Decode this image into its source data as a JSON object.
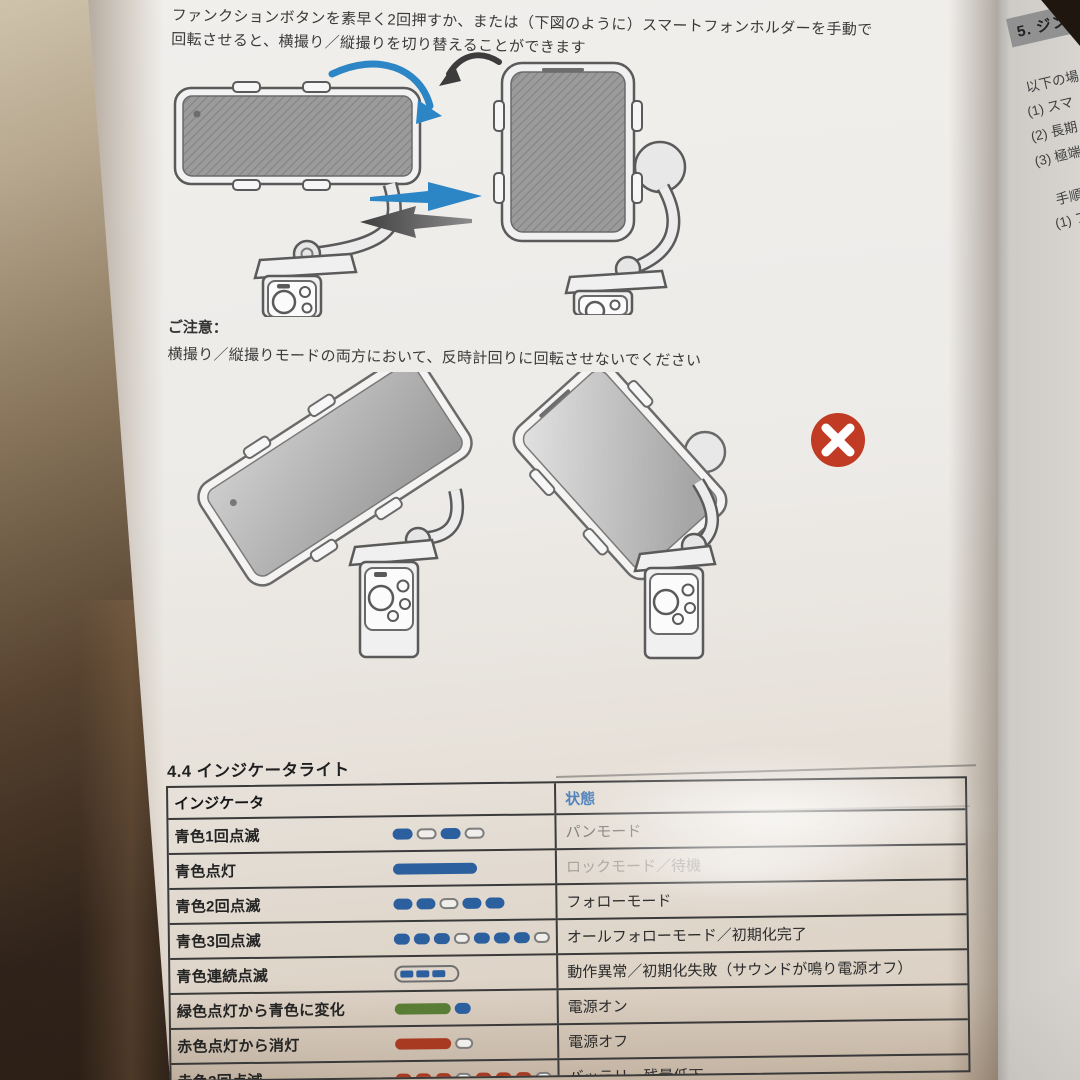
{
  "page": {
    "top_paragraph": {
      "line1": "ファンクションボタンを素早く2回押すか、または（下図のように）スマートフォンホルダーを手動で",
      "line2": "回転させると、横撮り／縦撮りを切り替えることができます"
    },
    "caution": {
      "title": "ご注意：",
      "body": "横撮り／縦撮りモードの両方において、反時計回りに回転させないでください"
    },
    "indicator_section": {
      "title": "4.4 インジケータライト",
      "table": {
        "headers": {
          "indicator": "インジケータ",
          "status": "状態"
        },
        "rows": [
          {
            "label": "青色1回点滅",
            "status": "パンモード",
            "pattern": {
              "kind": "pills",
              "items": [
                {
                  "color": "blue",
                  "w": 20
                },
                {
                  "color": "off",
                  "w": 20
                },
                {
                  "color": "blue",
                  "w": 20
                },
                {
                  "color": "off",
                  "w": 20
                }
              ]
            }
          },
          {
            "label": "青色点灯",
            "status": "ロックモード／待機",
            "pattern": {
              "kind": "pills",
              "items": [
                {
                  "color": "blue",
                  "w": 84
                }
              ]
            }
          },
          {
            "label": "青色2回点滅",
            "status": "フォローモード",
            "pattern": {
              "kind": "pills",
              "items": [
                {
                  "color": "blue",
                  "w": 19
                },
                {
                  "color": "blue",
                  "w": 19
                },
                {
                  "color": "off",
                  "w": 19
                },
                {
                  "color": "blue",
                  "w": 19
                },
                {
                  "color": "blue",
                  "w": 19
                }
              ]
            }
          },
          {
            "label": "青色3回点滅",
            "status": "オールフォローモード／初期化完了",
            "pattern": {
              "kind": "pills",
              "items": [
                {
                  "color": "blue",
                  "w": 16
                },
                {
                  "color": "blue",
                  "w": 16
                },
                {
                  "color": "blue",
                  "w": 16
                },
                {
                  "color": "off",
                  "w": 16
                },
                {
                  "color": "blue",
                  "w": 16
                },
                {
                  "color": "blue",
                  "w": 16
                },
                {
                  "color": "blue",
                  "w": 16
                },
                {
                  "color": "off",
                  "w": 16
                }
              ]
            }
          },
          {
            "label": "青色連続点滅",
            "status": "動作異常／初期化失敗（サウンドが鳴り電源オフ）",
            "pattern": {
              "kind": "capsule",
              "items": [
                {
                  "color": "blue"
                },
                {
                  "color": "blue"
                },
                {
                  "color": "blue"
                }
              ]
            }
          },
          {
            "label": "緑色点灯から青色に変化",
            "status": "電源オン",
            "pattern": {
              "kind": "pills",
              "items": [
                {
                  "color": "green",
                  "w": 56
                },
                {
                  "color": "blue",
                  "w": 16
                }
              ]
            }
          },
          {
            "label": "赤色点灯から消灯",
            "status": "電源オフ",
            "pattern": {
              "kind": "pills",
              "items": [
                {
                  "color": "red",
                  "w": 56
                },
                {
                  "color": "off",
                  "w": 18
                }
              ]
            }
          },
          {
            "label": "赤色3回点滅",
            "status": "バッテリー残量低下",
            "pattern": {
              "kind": "pills",
              "items": [
                {
                  "color": "red",
                  "w": 16
                },
                {
                  "color": "red",
                  "w": 16
                },
                {
                  "color": "red",
                  "w": 16
                },
                {
                  "color": "off",
                  "w": 16
                },
                {
                  "color": "red",
                  "w": 16
                },
                {
                  "color": "red",
                  "w": 16
                },
                {
                  "color": "red",
                  "w": 16
                },
                {
                  "color": "off",
                  "w": 16
                }
              ]
            }
          }
        ]
      }
    }
  },
  "right_page": {
    "heading": "5. ジン",
    "fragments": [
      "以下の場",
      "(1) スマ",
      "(2) 長期",
      "(3) 極端",
      "手順",
      "(1) フ",
      "(2)",
      "リセ",
      "(",
      "※",
      "音"
    ]
  },
  "icons": {
    "rotate_cw": "curved-arrow-clockwise",
    "rotate_ccw": "curved-arrow-counterclockwise",
    "switch_forward": "arrow-right",
    "switch_back": "arrow-left",
    "prohibited": "circle-x"
  },
  "colors": {
    "pattern": {
      "blue": "#2b5f9e",
      "green": "#5a7d35",
      "red": "#a83a22"
    },
    "status_header_blue": "#4c7fba",
    "accent_arrow_blue": "#2c85c5",
    "error_red": "#c13a24"
  }
}
